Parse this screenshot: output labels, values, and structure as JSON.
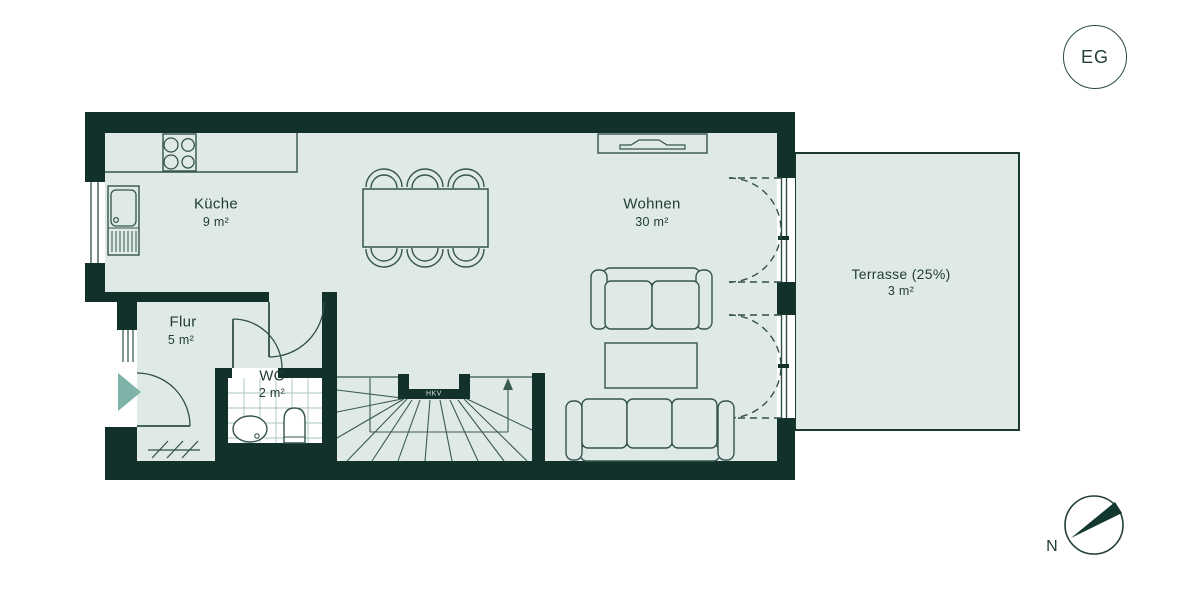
{
  "floorplan": {
    "level_badge": "EG",
    "compass_label": "N",
    "rooms": [
      {
        "name": "Küche",
        "area": "9 m²"
      },
      {
        "name": "Wohnen",
        "area": "30 m²"
      },
      {
        "name": "Flur",
        "area": "5 m²"
      },
      {
        "name": "WC",
        "area": "2 m²"
      },
      {
        "name": "Terrasse (25%)",
        "area": "3 m²"
      }
    ],
    "annotations": {
      "hkv": "HKV"
    },
    "colors": {
      "wall": "#11312a",
      "room_fill": "#dfeae7",
      "furniture_line": "#35544d",
      "entrance_arrow": "#7fb2a8",
      "text": "#1e3b34",
      "background": "#ffffff"
    }
  }
}
